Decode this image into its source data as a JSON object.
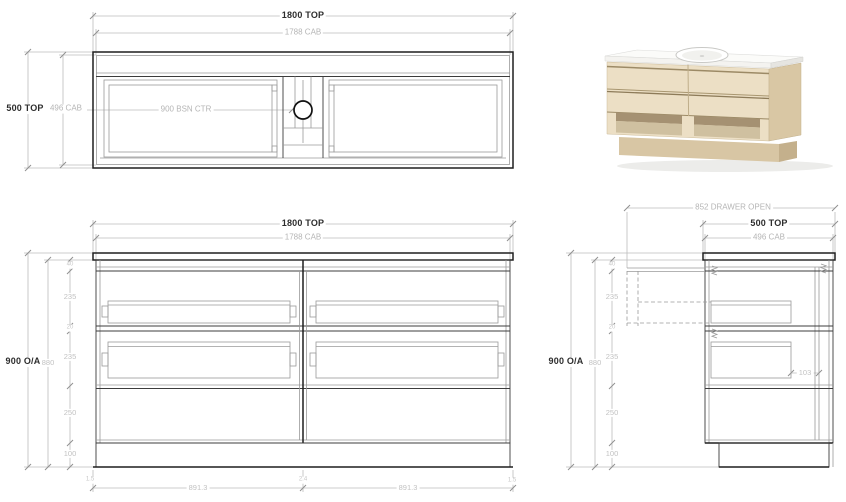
{
  "plan": {
    "width_overall": "1800 TOP",
    "width_cab": "1788 CAB",
    "depth_overall": "500 TOP",
    "depth_cab": "496 CAB",
    "basin_center": "900 BSN CTR"
  },
  "front": {
    "width_overall": "1800 TOP",
    "width_cab": "1788 CAB",
    "height_overall": "900 O/A",
    "height_cab": "880",
    "gap_top": "40",
    "drawer_h1": "235",
    "gap_mid": "20",
    "drawer_h2": "235",
    "shelf_h": "250",
    "kick_h": "100",
    "edge_l": "1.5",
    "front_w_l": "891.3",
    "gap_c": "2.4",
    "front_w_r": "891.3",
    "edge_r": "1.5"
  },
  "side": {
    "drawer_open": "852 DRAWER OPEN",
    "depth_overall": "500 TOP",
    "depth_cab": "496 CAB",
    "height_overall": "900 O/A",
    "height_cab": "880",
    "gap_top": "40",
    "drawer_h1": "235",
    "gap_mid": "20",
    "drawer_h2": "235",
    "shelf_h": "250",
    "kick_h": "100",
    "runner_clear": "103"
  },
  "colors": {
    "line_dark": "#1f1f1f",
    "line_dim": "#bcbcbc",
    "text_dark": "#2d2d2d",
    "text_dim": "#b5b5b5",
    "wood_front": "#ecdfc5",
    "wood_side": "#d9c7a4",
    "wood_plinth": "#d8c6a4",
    "opening_shadow": "#a59172",
    "opening_floor": "#cfc0a0",
    "counter": "#fbfbf9"
  }
}
